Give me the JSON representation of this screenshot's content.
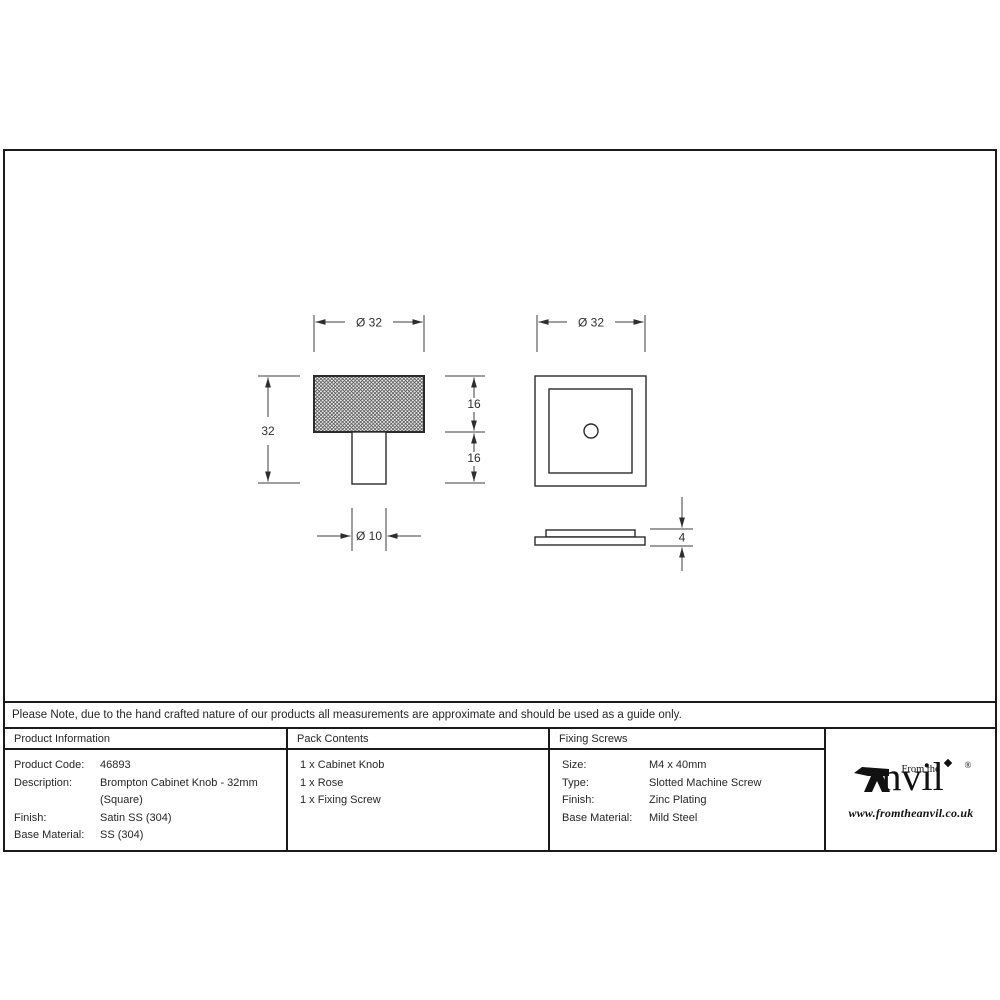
{
  "drawing": {
    "front_view": {
      "dim_width": "Ø 32",
      "dim_height": "32",
      "dim_head_depth": "16",
      "dim_stem_depth": "16",
      "dim_stem_width": "Ø 10"
    },
    "rose_view": {
      "dim_width": "Ø 32",
      "dim_thickness": "4"
    }
  },
  "note": {
    "text": "Please Note, due to the hand crafted nature of our products all measurements are approximate and should be used as a guide only."
  },
  "table": {
    "product_information": {
      "header": "Product Information",
      "rows": [
        {
          "label": "Product Code:",
          "value": "46893"
        },
        {
          "label": "Description:",
          "value": "Brompton Cabinet Knob - 32mm (Square)"
        },
        {
          "label": "Finish:",
          "value": "Satin SS (304)"
        },
        {
          "label": "Base Material:",
          "value": "SS (304)"
        }
      ]
    },
    "pack_contents": {
      "header": "Pack Contents",
      "items": [
        "1 x Cabinet Knob",
        "1 x Rose",
        "1 x Fixing Screw"
      ]
    },
    "fixing_screws": {
      "header": "Fixing Screws",
      "rows": [
        {
          "label": "Size:",
          "value": "M4 x 40mm"
        },
        {
          "label": "Type:",
          "value": "Slotted Machine Screw"
        },
        {
          "label": "Finish:",
          "value": "Zinc Plating"
        },
        {
          "label": "Base Material:",
          "value": "Mild Steel"
        }
      ]
    }
  },
  "brand": {
    "prefix": "From the",
    "name_rest": "nvil",
    "registered": "®",
    "url": "www.fromtheanvil.co.uk"
  },
  "colors": {
    "line": "#3c3c3c",
    "border": "#1a1a1a",
    "text": "#262626"
  }
}
